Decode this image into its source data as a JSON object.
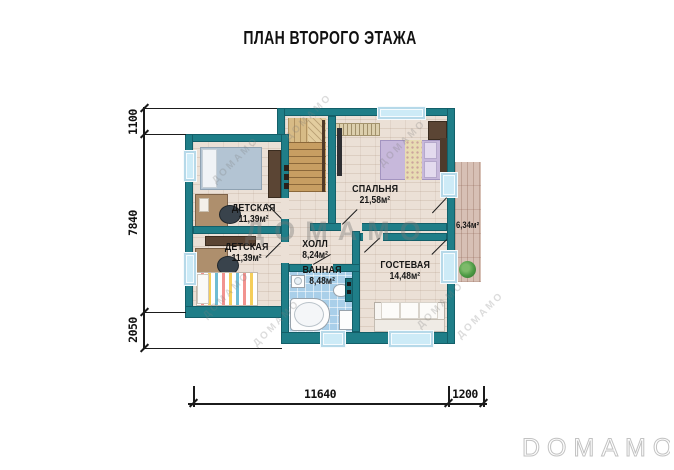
{
  "title": "ПЛАН ВТОРОГО ЭТАЖА",
  "rooms": [
    {
      "name": "ДЕТСКАЯ",
      "area": "11,39м²"
    },
    {
      "name": "СПАЛЬНЯ",
      "area": "21,58м²"
    },
    {
      "name": "ДЕТСКАЯ",
      "area": "11,39м²"
    },
    {
      "name": "ХОЛЛ",
      "area": "8,24м²"
    },
    {
      "name": "ВАННАЯ",
      "area": "8,48м²"
    },
    {
      "name": "ГОСТЕВАЯ",
      "area": "14,48м²"
    },
    {
      "area": "6,34м²"
    }
  ],
  "dimensions": {
    "left": [
      "1100",
      "7840",
      "2050"
    ],
    "bottom": [
      "11640",
      "1200"
    ]
  },
  "watermarks": {
    "center": "ДОМАМО",
    "diagonal": "ДОМАМО",
    "logo": "DOMAMO"
  },
  "colors": {
    "wall": "#1F7E88",
    "floor": "#EBE0D6",
    "bath_tile": "#A9CFE9",
    "balcony_wood": "#D7C0B5",
    "stair_wood": "#C79E62",
    "window_glass": "#CDEBF7"
  }
}
